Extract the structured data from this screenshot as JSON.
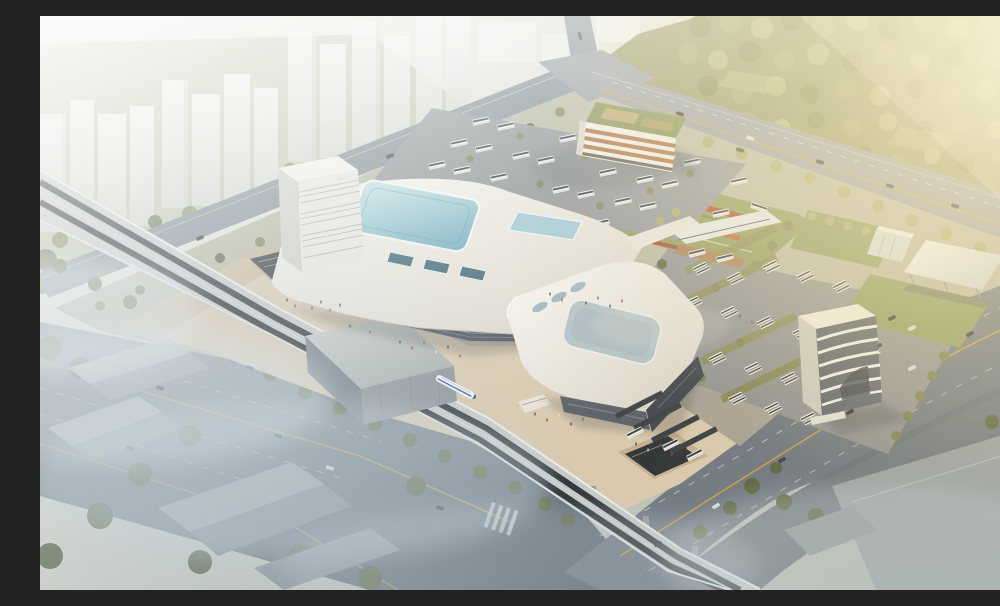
{
  "meta": {
    "type": "architectural-aerial-rendering",
    "subject": "Aerial rendering of an intermodal transit hub: two white curved-roof terminal halls with skylights, an elevated railway viaduct with a high-speed train, bus parking lots, office blocks, landscaped terraces, wide foggy arterial roads, hazy residential towers at upper left and sunlit woodland at upper right",
    "view": "oblique aerial, looking north-east",
    "lighting": "hazy golden sunlight from the upper right, mist over the foreground roads",
    "width_px": 1000,
    "height_px": 574
  },
  "elements": {
    "forest": "sunlit woodland, top right",
    "city_towers": "hazy white high-rise towers, top left",
    "main_terminal": "large white curved-roof terminal with aqua skylights and an L-shaped louvered office tower",
    "south_terminal": "second curved-roof hall with rounded grey skylight and dark glazed end",
    "railway_viaduct": "elevated double-track railway crossing the site diagonally",
    "high_speed_train": "white train with blue stripe on the viaduct",
    "train_shed": "grey box enclosure over the viaduct",
    "north_bus_lot": "asphalt lot with rows of parked white buses and trees",
    "east_depot": "coach parking with planted stalls, rows of coaches and canopies",
    "office_north": "slab office block with orange louvers and a green roof",
    "office_east": "office building with curved white horizontal bands",
    "terraces": "terraced planting mound with red flower bands",
    "highway": "wide foggy arterial road, bottom left",
    "avenue": "tree-lined avenue passing the station front, right side",
    "warehouses": "low grey industrial sheds in mist, bottom corners",
    "plaza": "beige pedestrian esplanade with sunken courts, escalators and crowds"
  },
  "palette": {
    "plaza": "#d9c9ae",
    "plazaDeep": "#c3b091",
    "roofWhite": "#f3f1ea",
    "roofShade": "#d8d3c6",
    "skylightAqua": "#8fc3ce",
    "skylightPale": "#bfe0e4",
    "skylightGrey": "#afc0c5",
    "facadeDark": "#4b545c",
    "glassDark": "#3e454c",
    "towerWhite": "#e7e6df",
    "road": "#7e8a93",
    "roadDark": "#5f6b75",
    "asphalt": "#8f9496",
    "laneYellow": "#d2a245",
    "laneWhite": "#dfe5e8",
    "viaductDeck": "#c6cac6",
    "trackDark": "#2e3439",
    "pierGrey": "#909a9e",
    "shedGrey": "#a9b1b2",
    "trainWhite": "#f5f7f8",
    "trainBlue": "#2f5f9e",
    "forestOlive": "#8d905c",
    "treeDark": "#5a6542",
    "treeOlive": "#7a8150",
    "treeGold": "#a8a86a",
    "lawn": "#8a9a5c",
    "flowerRed": "#a84e2a",
    "flowerRedLight": "#c05f33",
    "officeBand": "#a86d3c",
    "greenRoof": "#7c8a4a",
    "canopyWhite": "#eef0ee",
    "warehouseGrey": "#97a1a3",
    "cityTower": "#f3f4f1",
    "fog": "#dbe4e8",
    "glow": "#ffefc8",
    "busWhite": "#f1f2f0",
    "busStripe": "#31383d",
    "vehicleDark": "#2e343a"
  }
}
